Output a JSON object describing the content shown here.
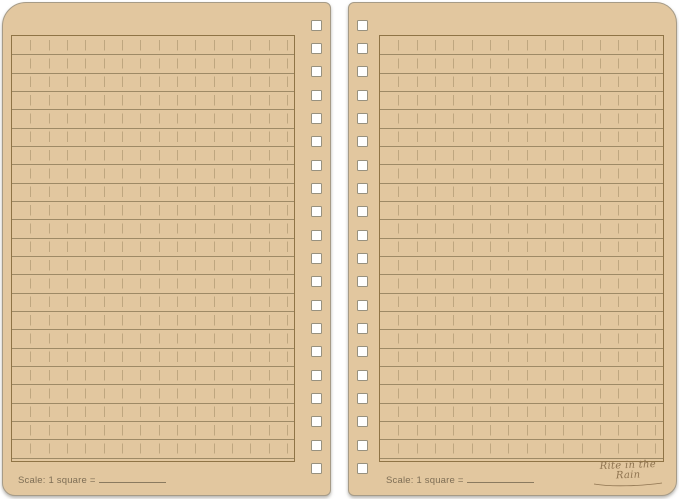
{
  "product": {
    "description": "Open spiral-bound tan notebook, two blank ruled pages",
    "brand_logo": "Rite in the Rain",
    "pages": [
      {
        "side": "left",
        "scale_label": "Scale: 1 square ="
      },
      {
        "side": "right",
        "scale_label": "Scale: 1 square ="
      }
    ]
  },
  "colors": {
    "background": "#FFFFFF",
    "paper": "#E2C79F",
    "rule_line": "#9E8A66",
    "dash_line": "#B29B74",
    "ruled_box_border": "#8F7446",
    "page_edge": "#A69B87",
    "text": "#7E6E55",
    "logo_text": "#8F7450",
    "hole_fill": "#FFFFFF",
    "hole_border": "#97917F"
  },
  "grid": {
    "cell_px": 18.33,
    "dash_gap_px": 4,
    "horizontal_rule_count": 23,
    "vertical_dashed_count": 15
  },
  "binding": {
    "hole_shape": "square",
    "holes_per_page": 20,
    "hole_size_px": 11,
    "hole_pitch_px": 23.35,
    "first_hole_top_px": 16.5
  }
}
